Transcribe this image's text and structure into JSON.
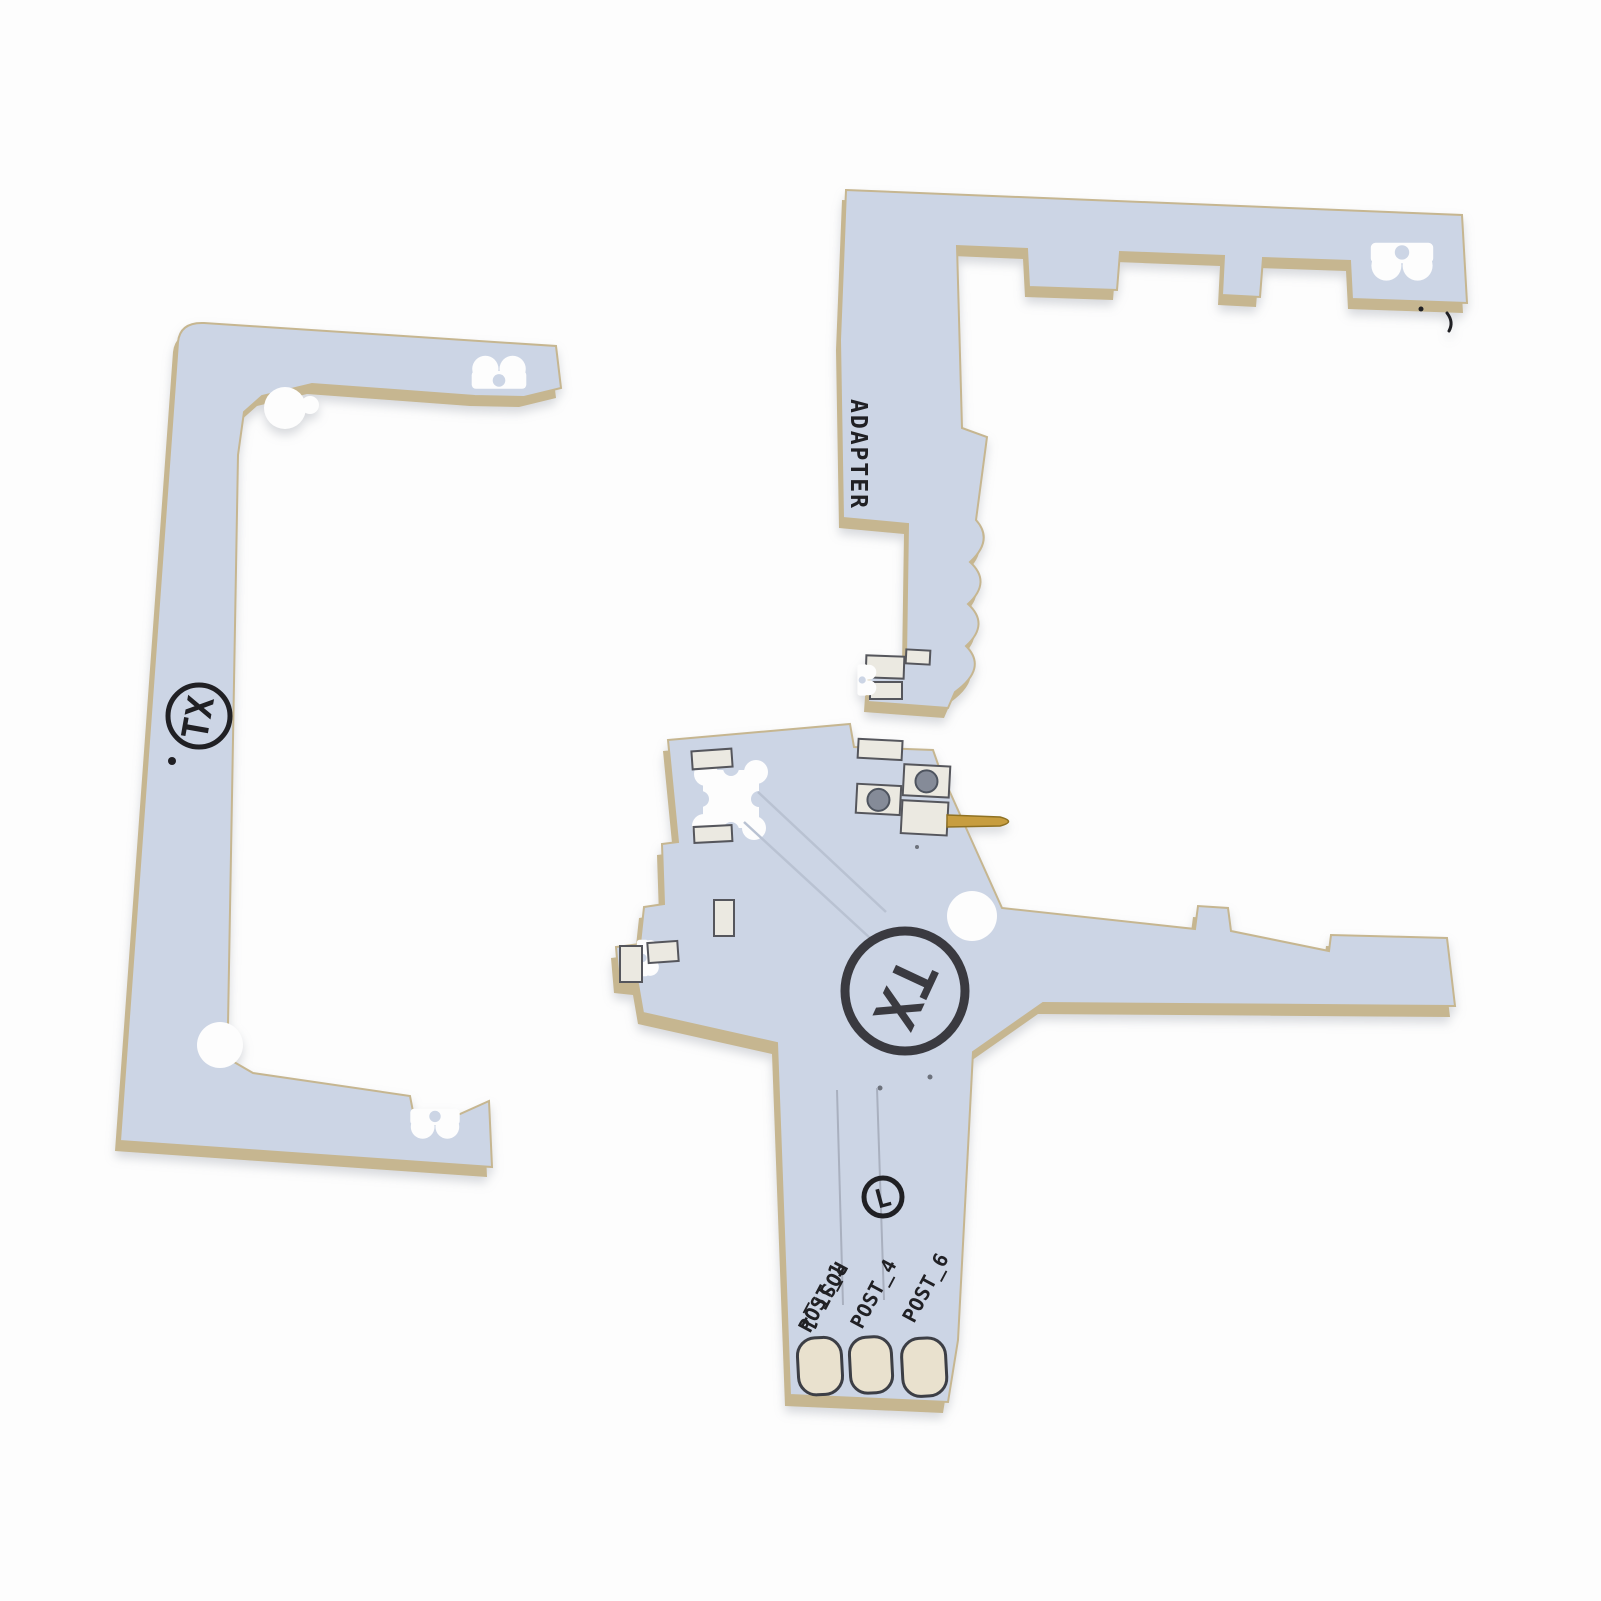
{
  "scene": {
    "description": "Two light-blue PCB flex adapter boards photographed on a white background",
    "background": "#fdfdfd"
  },
  "colors": {
    "bg": "#fdfdfd",
    "board_surface": "#ccd5e5",
    "board_edge": "#c6b690",
    "silkscreen": "#202024",
    "pad_silver": "#ebe9e1",
    "pad_outline": "#55565c",
    "pad_cream": "#e9e1ce",
    "cream_outline": "#3c3e45",
    "hole": "#858b98",
    "pin_gold": "#c79d3f"
  },
  "left_board": {
    "logo": "TX"
  },
  "adapter_board": {
    "label": "ADAPTER"
  },
  "main_board": {
    "logo": "TX",
    "marking": "L",
    "post_labels": [
      "POST_1",
      "POST_4",
      "POST_6"
    ],
    "post_label_mirror": "POST_1"
  }
}
